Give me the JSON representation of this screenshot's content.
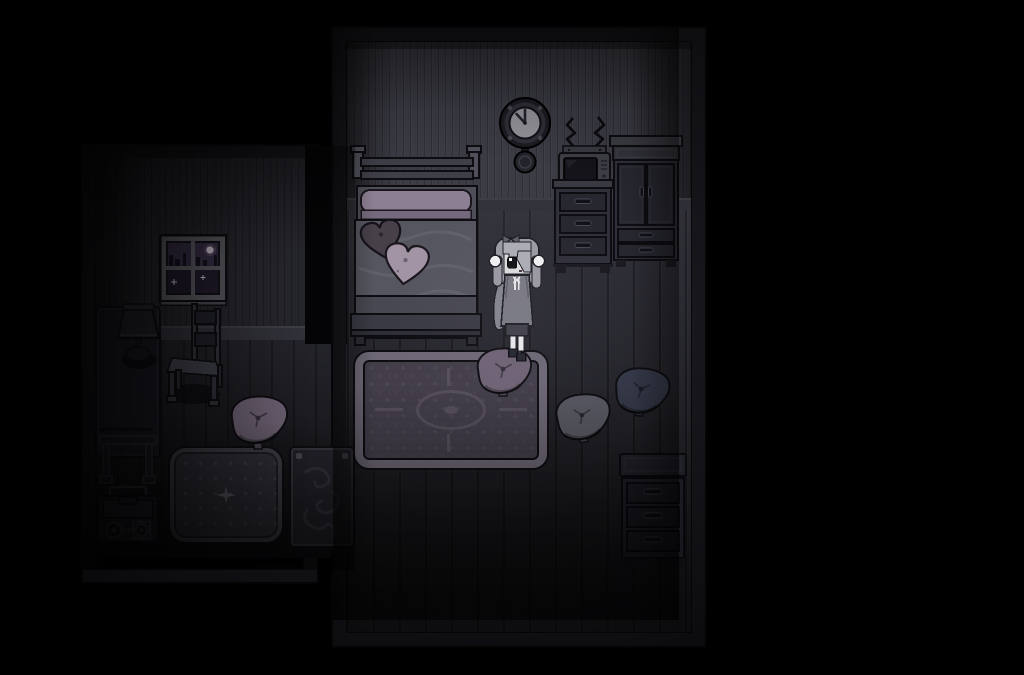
{
  "meta": {
    "resolution": "1024x675",
    "visible_text": "none",
    "style": "dark pixel-art RPG room at night"
  },
  "scene": {
    "setting": "dimly lit bedroom, night",
    "layout": "L-shaped room: large bedroom on the right, smaller alcove with window on the left"
  },
  "objects": {
    "clock": {
      "label": "pendulum wall clock",
      "time_shown": "10:00"
    },
    "tv": {
      "label": "vintage television with zigzag antennae"
    },
    "nightstand": {
      "label": "chest of drawers under TV",
      "drawer_count": 3
    },
    "wardrobe": {
      "label": "wardrobe with two doors and two drawers"
    },
    "bed": {
      "label": "single bed with gray blanket and mauve pillow"
    },
    "heart_pillow_dark": {
      "label": "dark heart-shaped pillow on bed"
    },
    "heart_pillow_light": {
      "label": "light heart-shaped pillow on bed"
    },
    "character": {
      "label": "girl with long gray hair covering one eye, gray dress, white leg warmers",
      "pose": "standing, facing viewer"
    },
    "area_rug": {
      "label": "large patterned area rug with medallion"
    },
    "cushion_center": {
      "label": "purple floor cushion at character's feet"
    },
    "cushion_gray": {
      "label": "gray floor cushion"
    },
    "cushion_navy": {
      "label": "navy floor cushion"
    },
    "cushion_left": {
      "label": "purple floor cushion in alcove"
    },
    "dresser": {
      "label": "small dark dresser",
      "drawer_count": 3
    },
    "window": {
      "label": "four-pane window showing purple night sky, moon and stars"
    },
    "desk": {
      "label": "side table"
    },
    "lamp": {
      "label": "table lamp on side table"
    },
    "chair": {
      "label": "wooden chair"
    },
    "mat": {
      "label": "square dotted mat with center sparkle"
    },
    "tapestry": {
      "label": "dark swirl-patterned rug"
    },
    "rack": {
      "label": "small folding rack"
    },
    "boombox": {
      "label": "cassette player with two reels"
    }
  },
  "palette": {
    "background": "#000000",
    "room-frame": "#17171c",
    "frame-edge": "#060608",
    "wall-main": "#3c3c45",
    "wall-left": "#26262d",
    "floor-main": "#2d2d35",
    "floor-left": "#1f1f26",
    "baseboard": "#32323a",
    "outline": "#0d0d11",
    "bed-frame": "#50505a",
    "bed-rail": "#3f3f48",
    "bed-mattress": "#4e4e58",
    "bed-blanket": "#565660",
    "bed-blanket-dark": "#484852",
    "bed-pillow": "#8d7f93",
    "bed-pillow-dark": "#756a7d",
    "heart-dark": "#474049",
    "heart-light": "#a294a4",
    "rug-border": "#6e6876",
    "rug-inner": "#433e4a",
    "rug-motif": "#564f5c",
    "cushion-purple": "#6f6375",
    "cushion-gray": "#585862",
    "cushion-navy": "#343847",
    "furniture-body": "#30303a",
    "furniture-face": "#272730",
    "furniture-dark": "#20202a",
    "furniture-darker": "#1b1b24",
    "handle": "#111118",
    "handle-rim": "#484853",
    "window-frame": "#5a5a62",
    "sky-top": "#342b42",
    "sky-bottom": "#1f1929",
    "moon": "#cfc3d2",
    "sparkle": "#cfc6d4",
    "clock-body": "#23232b",
    "clock-ring": "#2f2f38",
    "clock-face": "#94949b",
    "clock-hand": "#23232c",
    "screen": "#14141a",
    "char-hair": "#9b9ba4",
    "char-hair-light": "#aeaeb7",
    "char-hair-dark": "#85858f",
    "char-bow": "#5f5f69",
    "char-face": "#dedee0",
    "char-eye": "#121218",
    "char-dress": "#7a7a84",
    "char-skirt": "#41414a",
    "char-legs": "#ededef",
    "char-shoes": "#262630",
    "char-white": "#f2f2f4",
    "lamp-body": "#23232b",
    "tapestry-bg": "#23232a",
    "tapestry-swirl": "#32323c",
    "mat-bg": "#34343d",
    "mat-dot": "#45454f"
  }
}
